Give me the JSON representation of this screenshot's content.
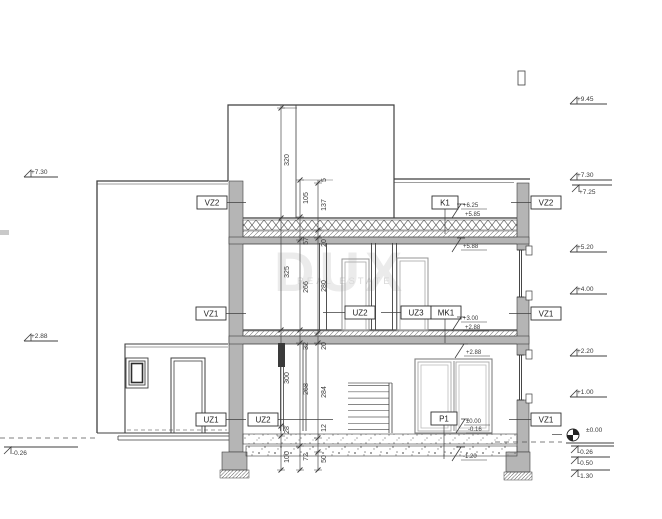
{
  "watermark": {
    "line1": "DUX",
    "line2": "REAL ESTATE"
  },
  "colors": {
    "line": "#3f3f3f",
    "wall_fill": "#b5b5b5",
    "dim_text": "#3a3a3a",
    "label_text": "#222222",
    "watermark_large": "#ebebeb",
    "watermark_small": "#d9d9d9"
  },
  "component_labels": [
    {
      "id": "vz2-left",
      "text": "VZ2",
      "x": 197,
      "y": 196,
      "w": 30,
      "leader": [
        227,
        202.5,
        246,
        202.5
      ]
    },
    {
      "id": "k1",
      "text": "K1",
      "x": 432,
      "y": 196,
      "w": 26,
      "leader": [
        445,
        209,
        445,
        234
      ]
    },
    {
      "id": "vz2-right",
      "text": "VZ2",
      "x": 531,
      "y": 196,
      "w": 30,
      "leader": [
        531,
        202.5,
        511,
        202.5
      ]
    },
    {
      "id": "vz1-left",
      "text": "VZ1",
      "x": 196,
      "y": 307,
      "w": 30,
      "leader": [
        226,
        313.5,
        246,
        313.5
      ]
    },
    {
      "id": "uz2-upper",
      "text": "UZ2",
      "x": 345,
      "y": 306,
      "w": 30,
      "leader": [
        345,
        312.5,
        323,
        312.5
      ]
    },
    {
      "id": "uz3",
      "text": "UZ3",
      "x": 401,
      "y": 306,
      "w": 30,
      "leader": [
        401,
        312.5,
        381,
        312.5
      ]
    },
    {
      "id": "mk1",
      "text": "MK1",
      "x": 431,
      "y": 306,
      "w": 30,
      "leader": [
        445,
        319,
        445,
        343
      ]
    },
    {
      "id": "vz1-right-upper",
      "text": "VZ1",
      "x": 531,
      "y": 307,
      "w": 30,
      "leader": [
        531,
        313.5,
        509,
        313.5
      ]
    },
    {
      "id": "uz1",
      "text": "UZ1",
      "x": 196,
      "y": 413,
      "w": 30,
      "leader": [
        226,
        419.5,
        246,
        419.5
      ]
    },
    {
      "id": "uz2-ground",
      "text": "UZ2",
      "x": 248,
      "y": 413,
      "w": 30,
      "leader": [
        278,
        419.5,
        333,
        419.5
      ]
    },
    {
      "id": "p1",
      "text": "P1",
      "x": 431,
      "y": 412,
      "w": 26,
      "leader": [
        444,
        425,
        444,
        459
      ]
    },
    {
      "id": "vz1-right-ground",
      "text": "VZ1",
      "x": 531,
      "y": 413,
      "w": 30,
      "leader": [
        531,
        419.5,
        509,
        419.5
      ]
    }
  ],
  "side_markers": [
    {
      "text": "+9.45",
      "tx": 577,
      "ty": 101,
      "lx1": 570,
      "lx2": 607,
      "ly": 104
    },
    {
      "text": "+7.30",
      "tx": 577,
      "ty": 177,
      "lx1": 570,
      "lx2": 612,
      "ly": 180
    },
    {
      "text": "+7.25",
      "tx": 579,
      "ty": 194,
      "lx1": 572,
      "lx2": 612,
      "ly": 185,
      "below": true
    },
    {
      "text": "+5.20",
      "tx": 577,
      "ty": 249,
      "lx1": 570,
      "lx2": 607,
      "ly": 252
    },
    {
      "text": "+4.00",
      "tx": 577,
      "ty": 291,
      "lx1": 570,
      "lx2": 607,
      "ly": 294
    },
    {
      "text": "+2.20",
      "tx": 577,
      "ty": 353,
      "lx1": 570,
      "lx2": 607,
      "ly": 356
    },
    {
      "text": "+1.00",
      "tx": 577,
      "ty": 394,
      "lx1": 570,
      "lx2": 607,
      "ly": 397
    },
    {
      "text": "±0.00",
      "tx": 586,
      "ty": 432,
      "lx1": 566,
      "lx2": 614,
      "ly": 443,
      "datum": true
    },
    {
      "text": "-0.26",
      "tx": 578,
      "ty": 454,
      "lx1": 571,
      "lx2": 614,
      "ly": 446,
      "below": true
    },
    {
      "text": "-0.50",
      "tx": 578,
      "ty": 465,
      "lx1": 571,
      "lx2": 610,
      "ly": 457,
      "below": true
    },
    {
      "text": "-1.30",
      "tx": 578,
      "ty": 478,
      "lx1": 571,
      "lx2": 610,
      "ly": 470,
      "below": true
    },
    {
      "text": "+7.30",
      "tx": 31,
      "ty": 174,
      "lx1": 24,
      "lx2": 58,
      "ly": 177
    },
    {
      "text": "+2.88",
      "tx": 31,
      "ty": 338,
      "lx1": 24,
      "lx2": 58,
      "ly": 341
    },
    {
      "text": "-0.26",
      "tx": 12,
      "ty": 455,
      "lx1": 4,
      "lx2": 78,
      "ly": 447,
      "below": true
    }
  ],
  "inner_markers": [
    {
      "text": "+6.25",
      "tx": 463,
      "ty": 207,
      "uy": 209
    },
    {
      "text": "+5.85",
      "tx": 465,
      "ty": 216,
      "uy": 218,
      "g": [
        452,
        218
      ]
    },
    {
      "text": "+5.88",
      "tx": 463,
      "ty": 248,
      "uy": 250,
      "g": [
        452,
        252
      ]
    },
    {
      "text": "+3.00",
      "tx": 463,
      "ty": 320,
      "uy": 322
    },
    {
      "text": "+2.88",
      "tx": 465,
      "ty": 329,
      "uy": 331,
      "g": [
        452,
        331
      ]
    },
    {
      "text": "+2.88",
      "tx": 466,
      "ty": 354,
      "uy": 356,
      "g": [
        455,
        358
      ]
    },
    {
      "text": "±0.00",
      "tx": 466,
      "ty": 423,
      "uy": 425
    },
    {
      "text": "-0.16",
      "tx": 468,
      "ty": 431,
      "uy": 433,
      "g": [
        456,
        433
      ]
    },
    {
      "text": "-1.20",
      "tx": 463,
      "ty": 458,
      "uy": 460,
      "g": [
        452,
        461
      ]
    }
  ],
  "dimension_chains": [
    {
      "x": 281,
      "y1": 106,
      "y2": 471,
      "ticks": [
        108,
        218,
        330,
        426,
        436,
        470
      ],
      "labels": [
        {
          "t": "320",
          "y": 160
        },
        {
          "t": "325",
          "y": 272
        },
        {
          "t": "300",
          "y": 378
        },
        {
          "t": "28",
          "y": 430
        },
        {
          "t": "100",
          "y": 457
        }
      ]
    },
    {
      "x": 300,
      "y1": 179,
      "y2": 471,
      "ticks": [
        180,
        217,
        240,
        330,
        343,
        446,
        470
      ],
      "labels": [
        {
          "t": "105",
          "y": 198
        },
        {
          "t": "57",
          "y": 241
        },
        {
          "t": "266",
          "y": 287
        },
        {
          "t": "32",
          "y": 346
        },
        {
          "t": "268",
          "y": 389
        },
        {
          "t": "72",
          "y": 457
        }
      ]
    },
    {
      "x": 318,
      "y1": 180,
      "y2": 471,
      "ticks": [
        183,
        230,
        238,
        333,
        343,
        438,
        452,
        470
      ],
      "labels": [
        {
          "t": "5",
          "y": 180
        },
        {
          "t": "137",
          "y": 205
        },
        {
          "t": "20",
          "y": 243
        },
        {
          "t": "280",
          "y": 286
        },
        {
          "t": "20",
          "y": 346
        },
        {
          "t": "284",
          "y": 392
        },
        {
          "t": "12",
          "y": 428
        },
        {
          "t": "50",
          "y": 459
        }
      ]
    }
  ]
}
